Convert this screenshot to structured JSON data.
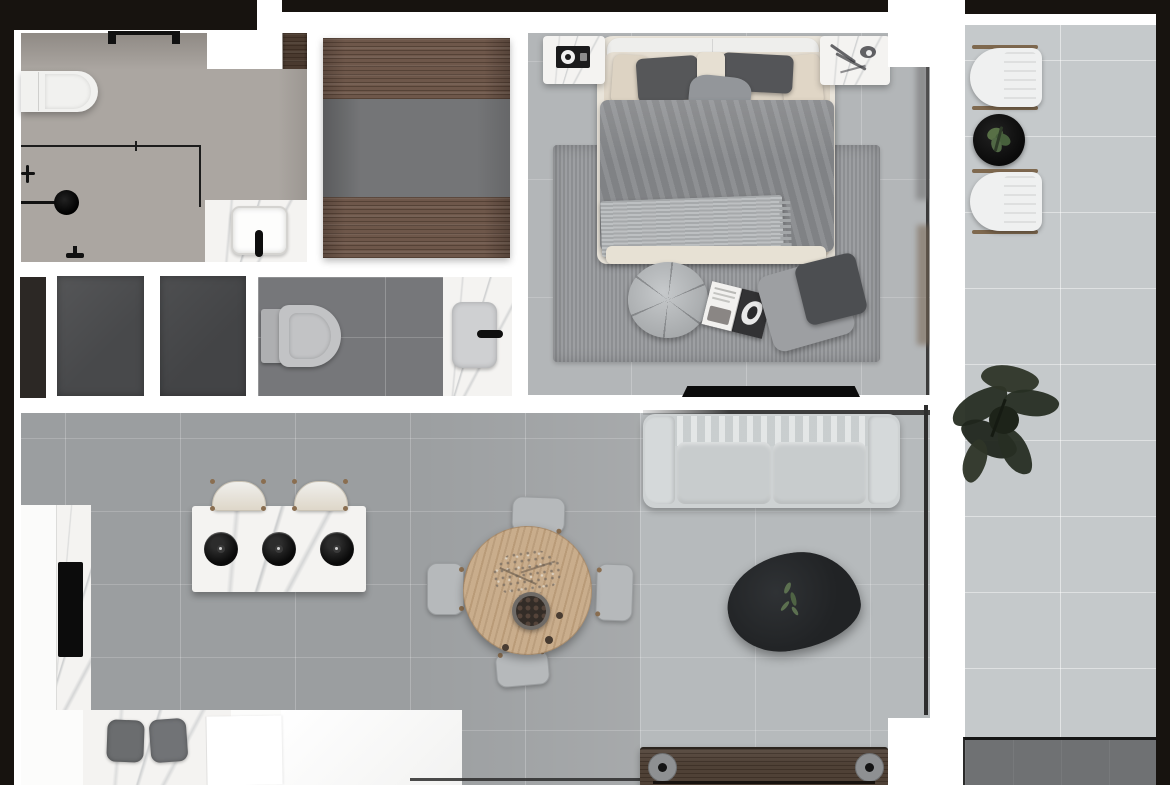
{
  "scene": {
    "type": "apartment-floor-plan-render",
    "view": "top-down",
    "rooms": [
      {
        "name": "bathroom",
        "items": [
          "wall-hung-toilet",
          "walk-in-shower",
          "rain-shower-head",
          "shower-glass-partition",
          "vanity-counter",
          "square-sink",
          "black-faucet",
          "sliding-door-rail"
        ]
      },
      {
        "name": "wardrobe-closet",
        "items": [
          "upper-wood-shelf-band",
          "hanging-area",
          "lower-wood-shelf-band"
        ]
      },
      {
        "name": "bedroom",
        "items": [
          "double-bed",
          "white-headboard",
          "dark-gray-pillows",
          "beige-pillows",
          "gray-duvet",
          "knit-throw",
          "nightstand-left",
          "nightstand-right",
          "area-rug",
          "segmented-round-pouf",
          "open-magazine",
          "two-floor-pillows",
          "wall-tv",
          "window-with-curtain"
        ]
      },
      {
        "name": "wc-hall",
        "items": [
          "dark-door-panel",
          "dark-panel-1",
          "dark-panel-2",
          "toilet",
          "marble-splash",
          "washbasin",
          "black-faucet"
        ]
      },
      {
        "name": "kitchen",
        "items": [
          "l-shaped-counter",
          "black-cooktop",
          "island-with-three-black-burners",
          "two-curved-bar-stools",
          "two-gray-stools",
          "bright-counter-panel"
        ]
      },
      {
        "name": "dining",
        "items": [
          "round-oak-table",
          "chair-top",
          "chair-bottom",
          "chair-left",
          "chair-right",
          "berry-bowl",
          "dried-flowers"
        ]
      },
      {
        "name": "living",
        "items": [
          "light-gray-sofa",
          "two-seat-cushions",
          "organic-black-coffee-table",
          "green-sprig",
          "window-frame-line",
          "low-wood-bench",
          "bench-wheels"
        ]
      },
      {
        "name": "balcony",
        "items": [
          "lounge-chair-top",
          "lounge-chair-bottom",
          "black-round-side-table",
          "potted-green-plant",
          "large-dark-plant",
          "dark-outdoor-mat",
          "tiled-floor"
        ]
      }
    ],
    "palette": {
      "structure_black": "#17130f",
      "wall_white": "#ffffff",
      "bathroom_floor": "#aba6a1",
      "closet_mid_gray": "#747577",
      "wood_brown": "#6e574a",
      "bench_wood": "#4f4136",
      "bedroom_floor": "#b3b6b8",
      "rug_gray": "#96989b",
      "duvet_gray": "#87898c",
      "throw_gray": "#afb2b4",
      "pillow_dark": "#565759",
      "pillow_beige": "#ddd3c3",
      "wc_floor": "#76777a",
      "panel_dark": "#48494b",
      "kitchen_floor": "#9b9ea0",
      "living_floor": "#b6babc",
      "balcony_floor": "#c5c9cb",
      "sofa_gray": "#ced2d3",
      "coffee_table_black": "#212325",
      "dining_wood": "#c9ad8c",
      "chair_gray": "#b6b9bb",
      "plant_green": "#587046",
      "mat_gray": "#6f7173",
      "tv_black": "#0b0b0b",
      "cooktop_black": "#0c0c0c"
    }
  }
}
